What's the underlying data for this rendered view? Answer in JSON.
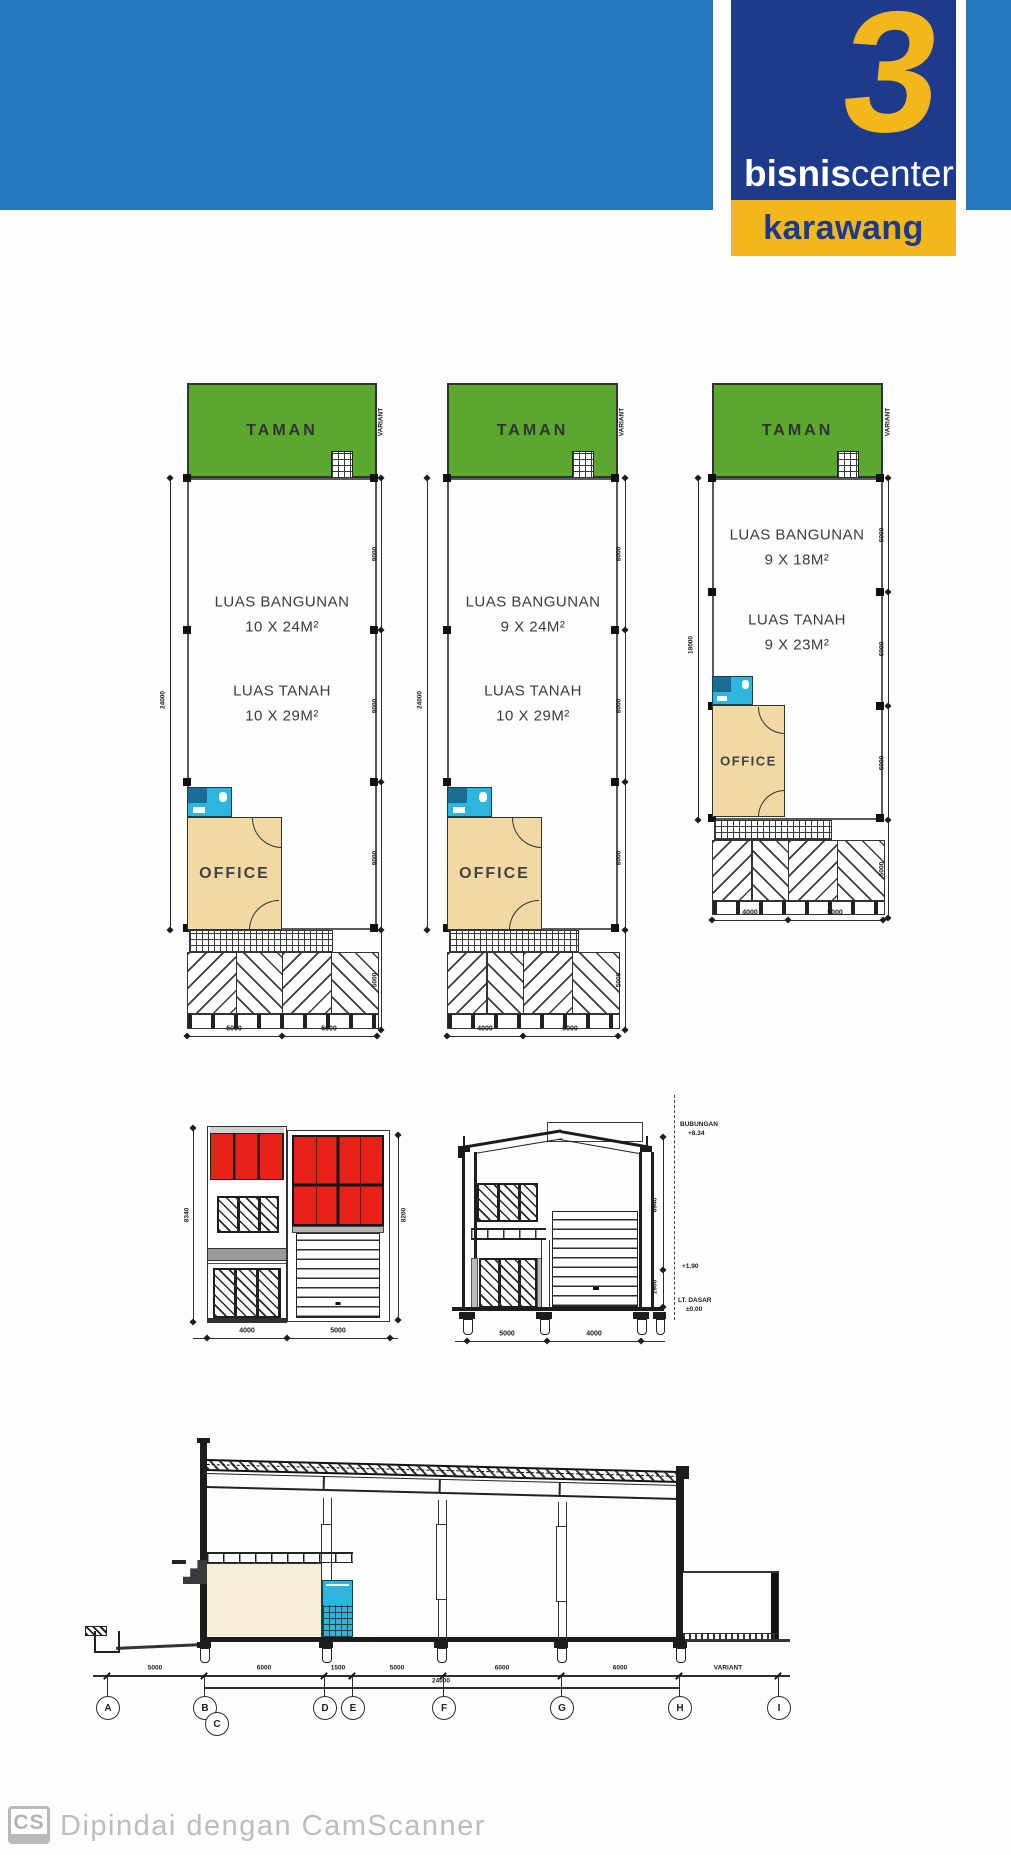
{
  "header": {
    "band_color": "#2478bd",
    "logo_number": "3",
    "brand_bold": "bisnis",
    "brand_light": "center",
    "city": "karawang",
    "navy": "#1e3a8c",
    "yellow": "#f3b71e"
  },
  "plans": [
    {
      "taman": "TAMAN",
      "variant": "VARIANT",
      "building_label": "LUAS BANGUNAN",
      "building_size": "10 X 24M²",
      "land_label": "LUAS TANAH",
      "land_size": "10 X 29M²",
      "office": "OFFICE",
      "overall_dim": "24000",
      "seg_dims": [
        "8000",
        "8000",
        "8000"
      ],
      "paving_dim": "5000",
      "front_dims": [
        "5000",
        "5000"
      ]
    },
    {
      "taman": "TAMAN",
      "variant": "VARIANT",
      "building_label": "LUAS BANGUNAN",
      "building_size": "9 X 24M²",
      "land_label": "LUAS TANAH",
      "land_size": "10 X 29M²",
      "office": "OFFICE",
      "overall_dim": "24000",
      "seg_dims": [
        "8000",
        "8000",
        "8000"
      ],
      "paving_dim": "5000",
      "front_dims": [
        "4000",
        "5000"
      ]
    },
    {
      "taman": "TAMAN",
      "variant": "VARIANT",
      "building_label": "LUAS BANGUNAN",
      "building_size": "9 X 18M²",
      "land_label": "LUAS TANAH",
      "land_size": "9 X 23M²",
      "office": "OFFICE",
      "overall_dim": "18000",
      "seg_dims": [
        "6000",
        "6000",
        "6000"
      ],
      "paving_dim": "5000",
      "front_dims": [
        "4000",
        "5000"
      ]
    }
  ],
  "elevation": {
    "left_dim": "8340",
    "right_dim": "8200",
    "bottom_dims": [
      "4000",
      "5000"
    ]
  },
  "section": {
    "ridge_label": "BUBUNGAN",
    "ridge_value": "+8.34",
    "height_dim": "6940",
    "mid_value": "+1.90",
    "lower_dim": "1900",
    "floor_label": "LT. DASAR",
    "floor_value": "±0.00",
    "bottom_dims": [
      "5000",
      "4000"
    ]
  },
  "long_section": {
    "top_dims": [
      "5000",
      "6000",
      "1500",
      "5000",
      "6000",
      "6000",
      "VARIANT"
    ],
    "total_dim": "24000",
    "grid_labels": [
      "A",
      "B",
      "C",
      "D",
      "E",
      "F",
      "G",
      "H",
      "I"
    ]
  },
  "footer": {
    "badge": "CS",
    "text": "Dipindai dengan CamScanner"
  },
  "colors": {
    "taman_green": "#5ba82f",
    "office_tan": "#f2d8a2",
    "toilet_cyan": "#2cb5dd",
    "glass_red": "#e7211a",
    "section_cream": "#f6eed6",
    "line": "#2e2e2e",
    "watermark": "#b9b9b9"
  }
}
